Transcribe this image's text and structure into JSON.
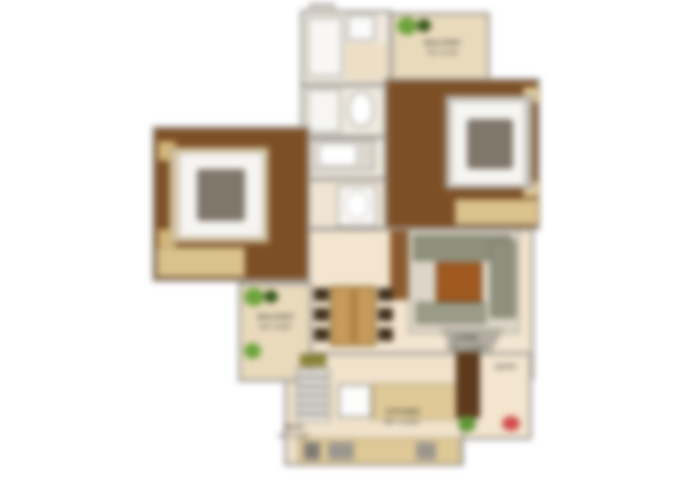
{
  "labels": {
    "balcony_top": {
      "name": "BALCONY",
      "dims": "7'6\" X 4'0\""
    },
    "balcony_left": {
      "name": "BALCONY",
      "dims": "5'0\" X 8'6\""
    },
    "living": {
      "name": "LIVING",
      "dims": "11'0\" X 14'6\""
    },
    "kitchen": {
      "name": "KITCHEN",
      "dims": "8'0\" X 10'0\""
    },
    "wash": {
      "name": "WASH",
      "dims": "3'0\" X 4'0\""
    },
    "entry": {
      "name": "ENTRY"
    }
  },
  "palette": {
    "wall": "#a29e98",
    "bedroom_floor": "#7d4f26",
    "living_floor": "#f3e5cf",
    "balcony_floor": "#e9dabc",
    "bath_floor": "#efe9df",
    "wardrobe_tan": "#e2cb97",
    "sofa_green": "#8e907c",
    "coffee_table_brown": "#a05a20",
    "dining_table_tan": "#c79b5b",
    "chair_dark": "#40301d",
    "plant_green": "#6da33c",
    "marker_red": "#d04b4b",
    "mattress_white": "#f6f5f2"
  },
  "icons": {
    "plant": "plant-icon",
    "entry_marker": "entry-marker-icon"
  }
}
